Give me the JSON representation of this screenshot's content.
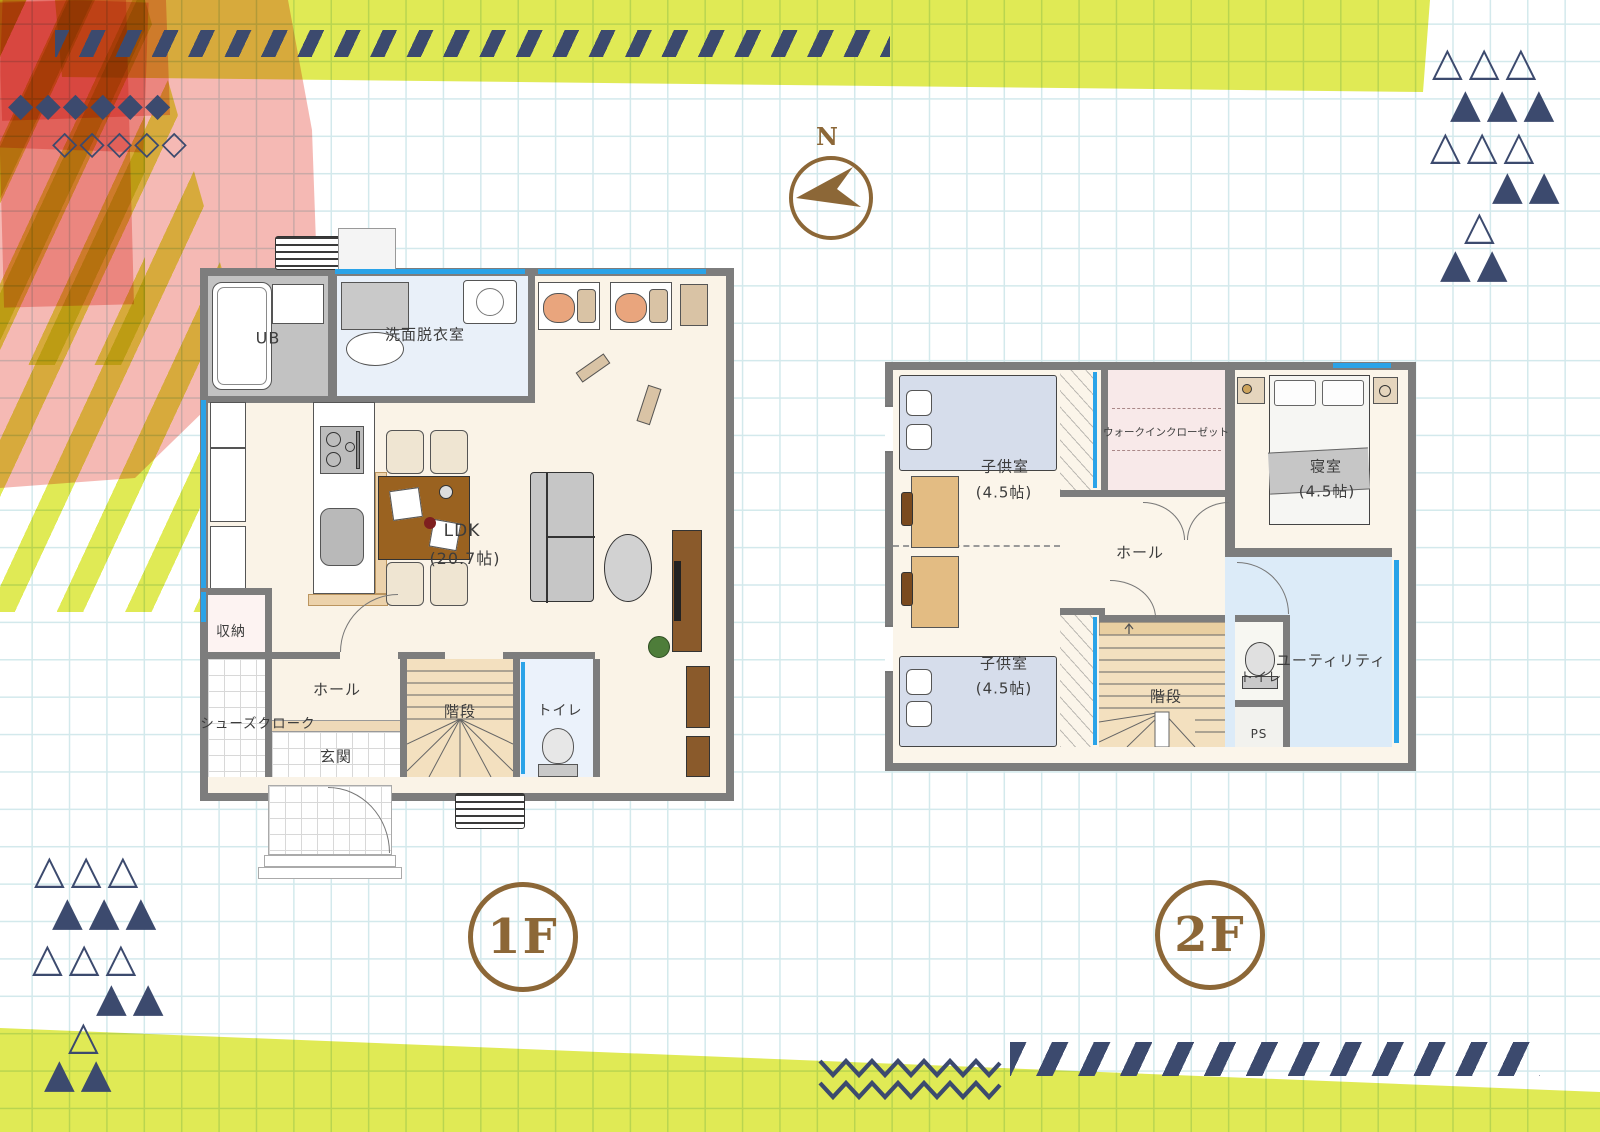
{
  "compass": {
    "label": "N"
  },
  "badges": {
    "floor1": "1F",
    "floor2": "2F"
  },
  "floor1": {
    "ub": "UB",
    "senmen": "洗面脱衣室",
    "ldk": "LDK",
    "ldk_size": "(20.7帖)",
    "shuno": "収納",
    "hall": "ホール",
    "shoes_cloak": "シューズクローク",
    "genkan": "玄関",
    "stairs": "階段",
    "toilet": "トイレ"
  },
  "floor2": {
    "kids_room_1": "子供室",
    "kids_room_1_size": "(4.5帖)",
    "wic": "ウォークインクローゼット",
    "bedroom": "寝室",
    "bedroom_size": "(4.5帖)",
    "hall": "ホール",
    "kids_room_2": "子供室",
    "kids_room_2_size": "(4.5帖)",
    "stairs": "階段",
    "toilet": "トイレ",
    "ps": "PS",
    "utility": "ユーティリティ"
  },
  "decor": {
    "diamonds_filled": "◆◆◆◆◆◆",
    "diamonds_outline": "◇◇◇◇◇",
    "tri_rows": [
      "△△△",
      "▲▲▲",
      "△△△",
      "▲▲",
      "△",
      "▲▲"
    ]
  },
  "colors": {
    "lime": "#e0ea55",
    "pink": "#f5b9b4",
    "navy": "#3c4a6e",
    "brown": "#8c6737",
    "window_blue": "#2aa3e8",
    "wall_gray": "#7d7d7d"
  }
}
